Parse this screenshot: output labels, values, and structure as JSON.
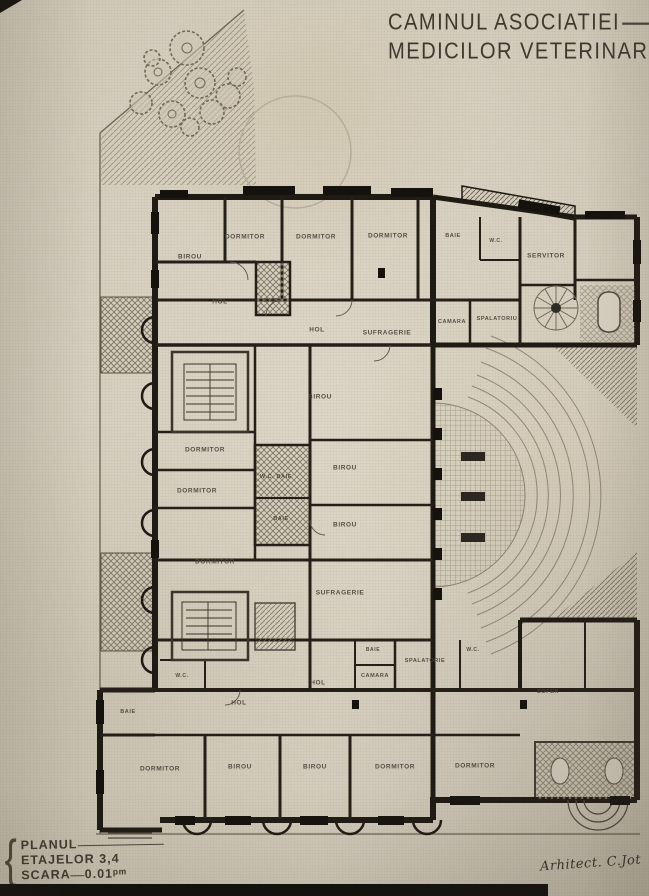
{
  "document": {
    "title_line1": "CAMINUL ASOCIATIEI",
    "title_line2": "MEDICILOR VETERINARI",
    "plan_label": "PLANUL",
    "plan_floors": "ETAJELOR 3,4",
    "scale_label": "SCARA",
    "scale_value": "0.01ᵖᵐ",
    "architect_signature": "Arhitect. C.Jot"
  },
  "colors": {
    "paper": "#d6cfbf",
    "ink": "#1e1a14",
    "hatch": "#8a8371",
    "label": "#4a453c"
  },
  "plan": {
    "rooms": [
      {
        "label": "BIROU",
        "x": 190,
        "y": 257
      },
      {
        "label": "DORMITOR",
        "x": 245,
        "y": 237
      },
      {
        "label": "DORMITOR",
        "x": 316,
        "y": 237
      },
      {
        "label": "DORMITOR",
        "x": 388,
        "y": 236
      },
      {
        "label": "BAIE",
        "x": 453,
        "y": 236,
        "size": 5.5
      },
      {
        "label": "W.C.",
        "x": 496,
        "y": 241,
        "size": 5
      },
      {
        "label": "SERVITOR",
        "x": 546,
        "y": 256
      },
      {
        "label": "HOL",
        "x": 220,
        "y": 302
      },
      {
        "label": "BAIE",
        "x": 271,
        "y": 301,
        "size": 5.5
      },
      {
        "label": "HOL",
        "x": 317,
        "y": 330
      },
      {
        "label": "SUFRAGERIE",
        "x": 387,
        "y": 333
      },
      {
        "label": "CAMARA",
        "x": 452,
        "y": 322,
        "size": 5.5
      },
      {
        "label": "SPALATORIU",
        "x": 497,
        "y": 319,
        "size": 5.5
      },
      {
        "label": "BIROU",
        "x": 320,
        "y": 397
      },
      {
        "label": "DORMITOR",
        "x": 205,
        "y": 450
      },
      {
        "label": "DORMITOR",
        "x": 197,
        "y": 491
      },
      {
        "label": "W.C. BAIE",
        "x": 276,
        "y": 477,
        "size": 5.5
      },
      {
        "label": "BIROU",
        "x": 345,
        "y": 468
      },
      {
        "label": "BAIE",
        "x": 281,
        "y": 519,
        "size": 5.5
      },
      {
        "label": "BIROU",
        "x": 345,
        "y": 525
      },
      {
        "label": "DORMITOR",
        "x": 215,
        "y": 562
      },
      {
        "label": "SUFRAGERIE",
        "x": 340,
        "y": 593
      },
      {
        "label": "BAIE",
        "x": 373,
        "y": 650,
        "size": 5
      },
      {
        "label": "SPALATORIE",
        "x": 425,
        "y": 661,
        "size": 5.5
      },
      {
        "label": "CAMARA",
        "x": 375,
        "y": 676,
        "size": 5.5
      },
      {
        "label": "W.C.",
        "x": 473,
        "y": 650,
        "size": 5
      },
      {
        "label": "W.C.",
        "x": 182,
        "y": 676,
        "size": 5
      },
      {
        "label": "HOL",
        "x": 318,
        "y": 683
      },
      {
        "label": "HOL",
        "x": 239,
        "y": 703
      },
      {
        "label": "BAIE",
        "x": 128,
        "y": 712,
        "size": 5.5
      },
      {
        "label": "DORMITOR",
        "x": 160,
        "y": 769
      },
      {
        "label": "BIROU",
        "x": 240,
        "y": 767
      },
      {
        "label": "BIROU",
        "x": 315,
        "y": 767
      },
      {
        "label": "DORMITOR",
        "x": 395,
        "y": 767
      },
      {
        "label": "DORMITOR",
        "x": 475,
        "y": 766
      },
      {
        "label": "SOFER",
        "x": 548,
        "y": 692,
        "size": 5.5
      }
    ]
  }
}
